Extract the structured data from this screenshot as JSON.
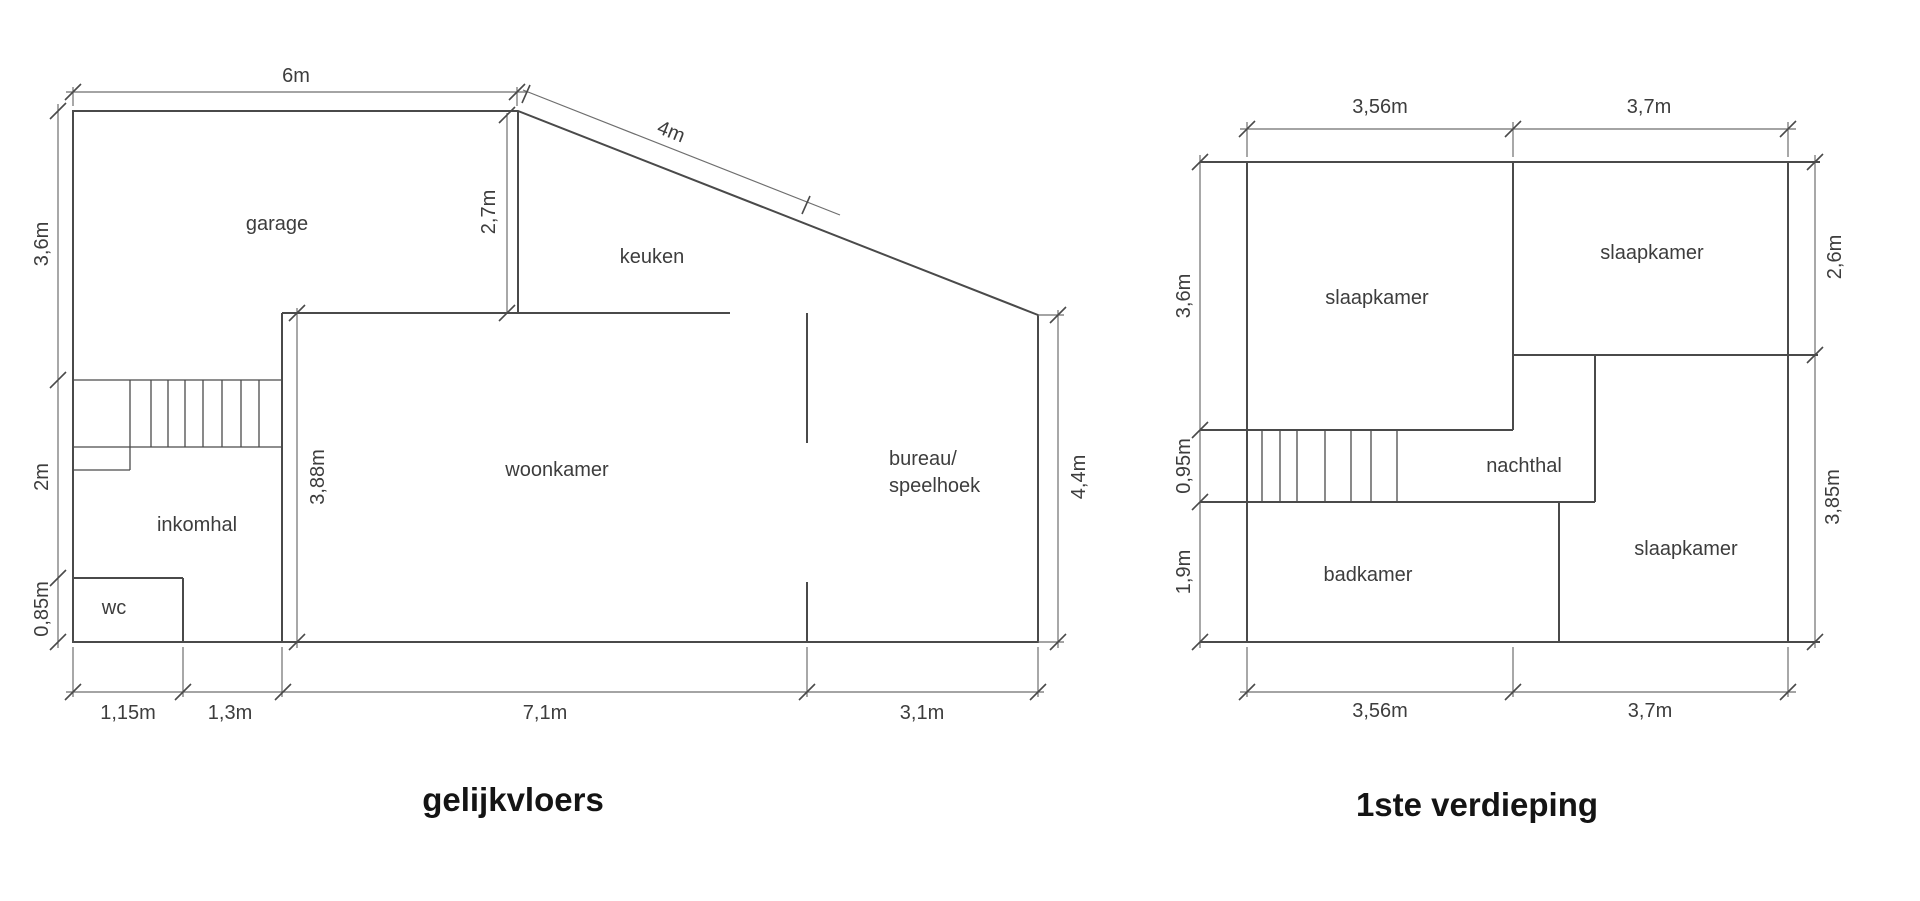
{
  "colors": {
    "background": "#ffffff",
    "wall_line": "#4a4a4a",
    "dimension_line": "#6e6e6e",
    "label_text": "#3d3d3d",
    "title_text": "#141414"
  },
  "ground_floor": {
    "title": "gelijkvloers",
    "rooms": {
      "garage": "garage",
      "keuken": "keuken",
      "woonkamer": "woonkamer",
      "inkomhal": "inkomhal",
      "wc": "wc",
      "bureau_line1": "bureau/",
      "bureau_line2": "speelhoek"
    },
    "dimensions": {
      "top_width": "6m",
      "roof_slope": "4m",
      "left_upper": "3,6m",
      "left_middle": "2m",
      "left_lower": "0,85m",
      "keuken_height": "2,7m",
      "woonkamer_height": "3,88m",
      "right_height": "4,4m",
      "bottom_wc": "1,15m",
      "bottom_hal": "1,3m",
      "bottom_woonkamer": "7,1m",
      "bottom_bureau": "3,1m"
    }
  },
  "first_floor": {
    "title": "1ste verdieping",
    "rooms": {
      "slaapkamer_top_left": "slaapkamer",
      "slaapkamer_top_right": "slaapkamer",
      "slaapkamer_bottom_right": "slaapkamer",
      "nachthal": "nachthal",
      "badkamer": "badkamer"
    },
    "dimensions": {
      "top_left_width": "3,56m",
      "top_right_width": "3,7m",
      "left_upper": "3,6m",
      "left_middle": "0,95m",
      "left_lower": "1,9m",
      "right_upper": "2,6m",
      "right_lower": "3,85m",
      "bottom_left_width": "3,56m",
      "bottom_right_width": "3,7m"
    }
  }
}
